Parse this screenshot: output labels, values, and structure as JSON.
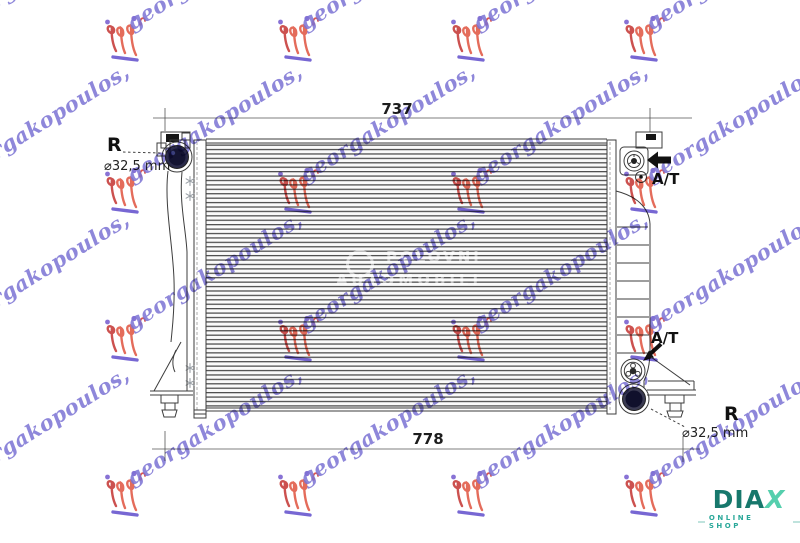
{
  "dimensions": {
    "top": "737",
    "bottom": "778"
  },
  "callouts": {
    "top_left_r": "R",
    "top_left_diameter": "⌀32,5 mm",
    "bottom_right_r": "R",
    "bottom_right_diameter": "⌀32,5 mm",
    "top_right_at": "A/T",
    "bottom_right_at": "A/T"
  },
  "watermark": {
    "text": "georgakopoulos,"
  },
  "center_watermark": {
    "line1": "POLOVNI",
    "line2": "AUTOMOBILI"
  },
  "diax_logo": {
    "part1": "DIA",
    "part2": "X",
    "tagline": "ONLINE SHOP"
  },
  "colors": {
    "line": "#3c3c3c",
    "watermark_purple": "#7b72d4",
    "watermark_red": "#e2604e",
    "watermark_crimson": "#c84340",
    "port_dark": "#141432",
    "diax_dark": "#17786c",
    "diax_light": "#55cfad"
  }
}
